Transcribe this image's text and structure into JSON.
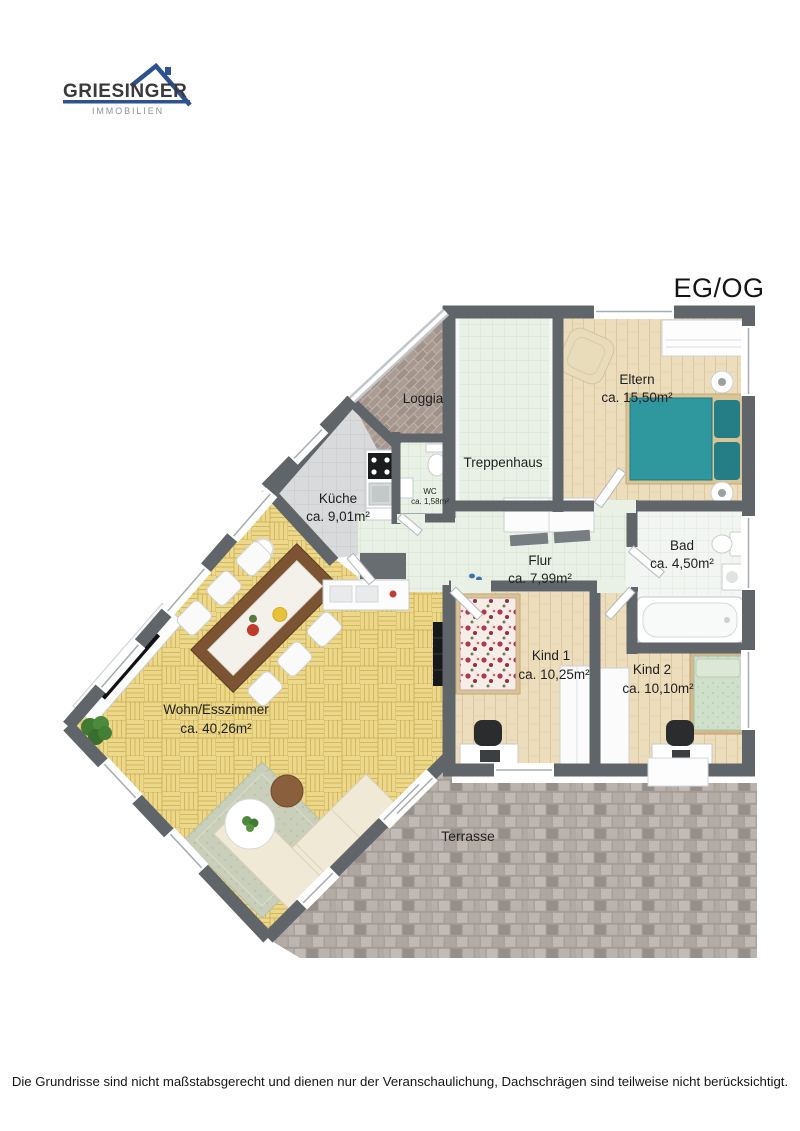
{
  "logo": {
    "brand": "GRIESINGER",
    "tagline": "IMMOBILIEN"
  },
  "title": "EG/OG",
  "rooms": {
    "loggia": {
      "name": "Loggia"
    },
    "treppenhaus": {
      "name": "Treppenhaus"
    },
    "eltern": {
      "name": "Eltern",
      "area": "ca. 15,50m²"
    },
    "kueche": {
      "name": "Küche",
      "area": "ca. 9,01m²"
    },
    "wc": {
      "name": "WC",
      "area": "ca. 1,58m²"
    },
    "flur": {
      "name": "Flur",
      "area": "ca. 7,99m²"
    },
    "bad": {
      "name": "Bad",
      "area": "ca. 4,50m²"
    },
    "kind1": {
      "name": "Kind 1",
      "area": "ca. 10,25m²"
    },
    "kind2": {
      "name": "Kind 2",
      "area": "ca. 10,10m²"
    },
    "wohnen": {
      "name": "Wohn/Esszimmer",
      "area": "ca. 40,26m²"
    },
    "terrasse": {
      "name": "Terrasse"
    }
  },
  "footer": {
    "disclaimer": "Die Grundrisse sind nicht maßstabsgerecht und dienen nur der Veranschaulichung, Dachschrägen sind teilweise nicht berücksichtigt."
  },
  "colors": {
    "wall": "#60656a",
    "logo_blue": "#2e5190",
    "parquet": "#ecd88a",
    "wood": "#ecddbd",
    "tile_green": "#e9f0e5",
    "tile_white": "#f2f5f1",
    "tile_gray": "#d8dadb",
    "terrace": "#b5aea8",
    "bed_teal": "#2e989e",
    "sofa_cream": "#f0e9d5"
  }
}
